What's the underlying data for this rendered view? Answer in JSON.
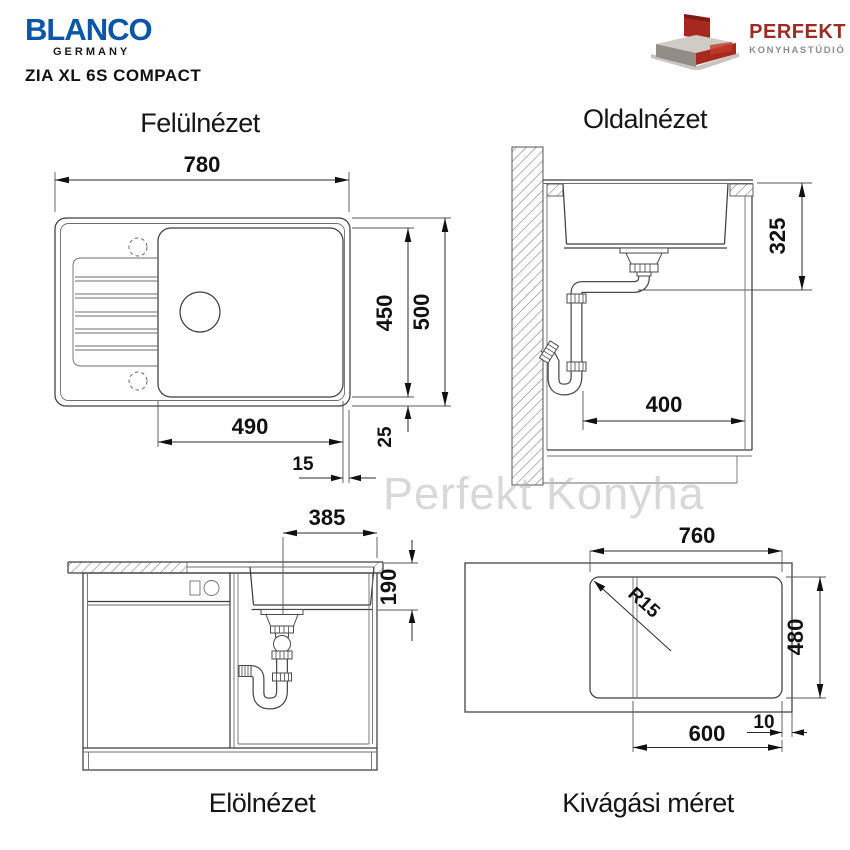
{
  "header": {
    "brand_name": "BLANCO",
    "brand_country": "GERMANY",
    "product_title": "ZIA XL 6S COMPACT",
    "dealer_name": "PERFEKT",
    "dealer_subtitle": "KONYHASTÚDIÓ",
    "colors": {
      "blanco_blue": "#0a57a7",
      "perfekt_red": "#9e2b23",
      "dealer_gray": "#8e8e8e"
    }
  },
  "watermark": "Perfekt Konyha",
  "views": {
    "top": {
      "title": "Felülnézet",
      "dims": {
        "overall_width": "780",
        "overall_depth": "500",
        "inner_depth": "450",
        "bowl_width": "490",
        "edge_offset": "15",
        "rear_margin": "25"
      }
    },
    "side": {
      "title": "Oldalnézet",
      "dims": {
        "install_depth": "325",
        "cabinet_clearance": "400"
      }
    },
    "front": {
      "title": "Elölnézet",
      "dims": {
        "drain_offset": "385",
        "bowl_depth": "190"
      }
    },
    "cutout": {
      "title": "Kivágási méret",
      "dims": {
        "cutout_width": "760",
        "cutout_depth": "480",
        "corner_radius": "R15",
        "edge_distance": "10",
        "drain_line_offset": "600"
      }
    }
  }
}
